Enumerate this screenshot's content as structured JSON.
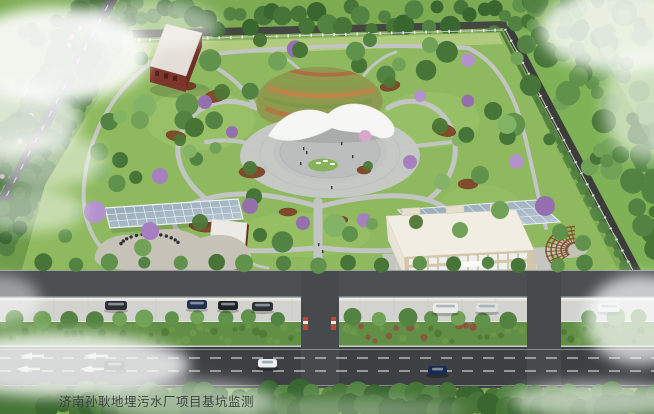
{
  "caption": {
    "text": "济南孙耿地埋污水厂项目基坑监测"
  },
  "scene": {
    "type": "aerial-architectural-rendering",
    "objects": [
      "perimeter-road-west",
      "boundary-forest",
      "boundary-fence",
      "park-lawn",
      "park-paths",
      "flower-mound",
      "canopy-structure",
      "central-plaza",
      "red-brick-building",
      "greenhouse",
      "utility-building",
      "office-building",
      "solar-canopy",
      "pergola",
      "internal-road",
      "sidewalk-parking",
      "median-hedge",
      "main-road",
      "entrance-gate",
      "vehicles",
      "fog-overlay"
    ]
  },
  "palette": {
    "base": "#7daa52",
    "park": "#8eb95f",
    "path": "#c3c5c4",
    "plaza": "#c6c8c7",
    "roadmain": "#3d4143",
    "roadinner": "#4b4f51",
    "sidewalk": "#d2d3cf",
    "median": "#628f46",
    "redwall": "#7e352c",
    "roof": "#f0ece2",
    "cream": "#d3c6a9",
    "glasslight": "#bccbd6",
    "glassdark": "#8fa3b3",
    "wood": "#8a5430",
    "purple": "#a57fc0",
    "fog": "#ffffff",
    "captioncolor": "#333937"
  }
}
